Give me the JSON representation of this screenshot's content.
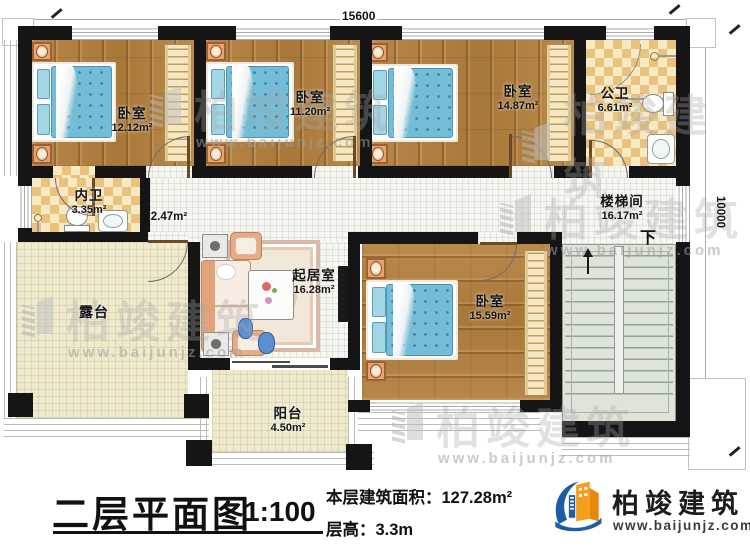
{
  "title_block": {
    "plan_title": "二层平面图",
    "scale": "1:100",
    "area_label": "本层建筑面积：",
    "area_value": "127.28m²",
    "height_label": "层高：",
    "height_value": "3.3m"
  },
  "brand": {
    "name": "柏竣建筑",
    "url": "www.baijunjz.com"
  },
  "watermark": {
    "name": "柏竣建筑",
    "url": "www.baijunjz.com"
  },
  "dimensions": {
    "top": "15600",
    "right": "10000"
  },
  "stairs": {
    "down": "下"
  },
  "rooms": {
    "bedroom1": {
      "name": "卧室",
      "area": "12.12m²"
    },
    "bedroom2": {
      "name": "卧室",
      "area": "11.20m²"
    },
    "bedroom3": {
      "name": "卧室",
      "area": "14.87m²"
    },
    "bedroom4": {
      "name": "卧室",
      "area": "15.59m²"
    },
    "public_bath": {
      "name": "公卫",
      "area": "6.61m²"
    },
    "private_bath": {
      "name": "内卫",
      "area": "3.35m²"
    },
    "hallway": {
      "area": "2.47m²"
    },
    "stair_hall": {
      "name": "楼梯间",
      "area": "16.17m²"
    },
    "living": {
      "name": "起居室",
      "area": "16.28m²"
    },
    "terrace": {
      "name": "露台"
    },
    "balcony": {
      "name": "阳台",
      "area": "4.50m²"
    }
  }
}
